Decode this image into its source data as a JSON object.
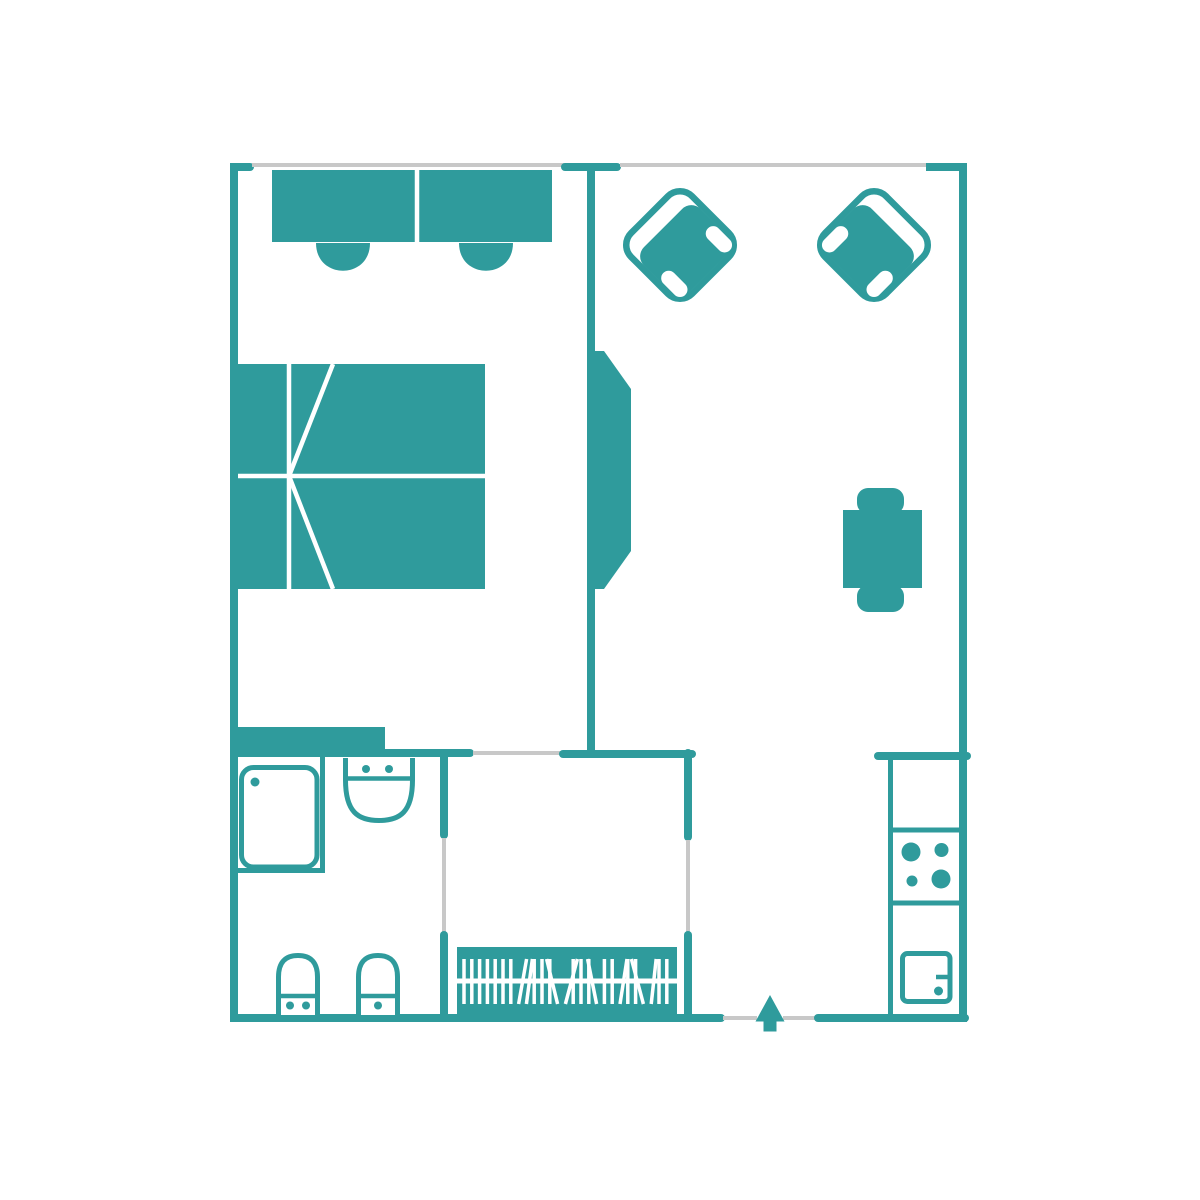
{
  "plan": {
    "kind": "apartment floor plan",
    "view": "top-down",
    "rooms": [
      {
        "name": "bedroom",
        "items": [
          "desk",
          "desk chair",
          "desk chair",
          "double bed",
          "built-in wardrobe"
        ]
      },
      {
        "name": "living room",
        "items": [
          "armchair",
          "armchair",
          "dining table",
          "dining chair",
          "dining chair"
        ]
      },
      {
        "name": "bathroom",
        "items": [
          "vanity counter",
          "wash basin",
          "shower cabin",
          "toilet",
          "bidet"
        ]
      },
      {
        "name": "walk-in closet",
        "items": [
          "clothes rail with hangers"
        ]
      },
      {
        "name": "kitchen",
        "items": [
          "kitchen counter",
          "cooktop",
          "kitchen sink"
        ]
      },
      {
        "name": "entrance",
        "items": [
          "entry direction arrow"
        ]
      }
    ]
  },
  "colors": {
    "structure": "#2F9B9C",
    "opening": "#C8C8C8",
    "background": "#FFFFFF",
    "detail": "#FFFFFF"
  },
  "kitchen": {
    "burner_count": 4
  },
  "closet": {
    "hanger_tilts": [
      0,
      0,
      0,
      0,
      0,
      0,
      0,
      8,
      6,
      0,
      0,
      0,
      -11,
      12,
      0,
      0,
      0,
      -9,
      0,
      0,
      7,
      0,
      0,
      -12,
      5,
      0,
      0
    ],
    "hanger_start_x": 464,
    "hanger_step": 7.8,
    "hanger_top_y": 959,
    "hanger_bottom_y": 1004
  },
  "entrance": {
    "arrow_direction": "up"
  }
}
